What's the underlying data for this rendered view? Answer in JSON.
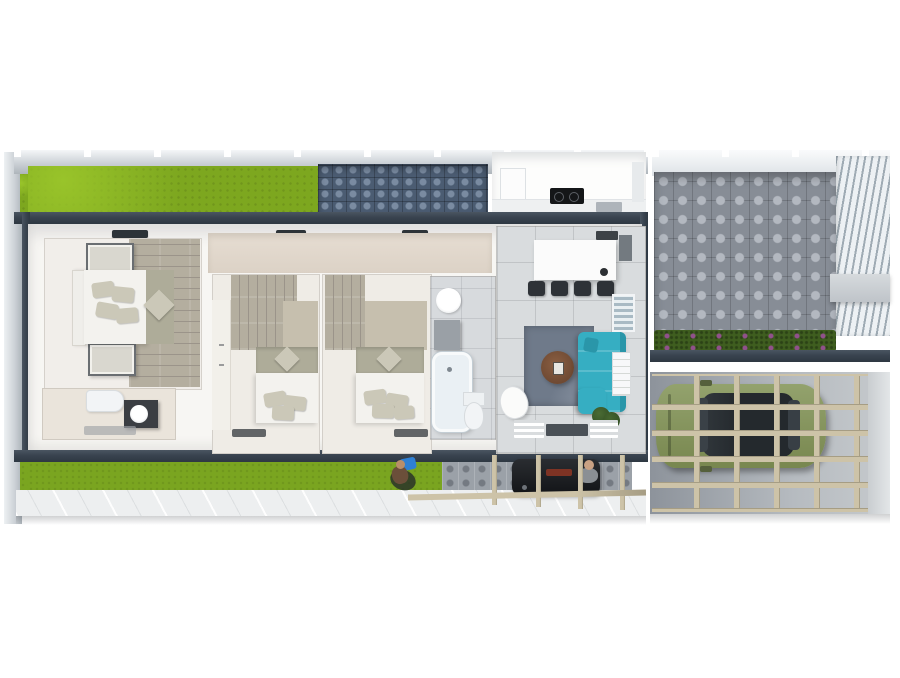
{
  "scene": {
    "description": "3D rendered top-down floor plan of a single-story house with attached carport, courtyard patio, lawns and BBQ area",
    "image_type": "architectural-3d-render-top-view",
    "visible_text": "none"
  },
  "colors": {
    "bg": "#ffffff",
    "fence": "#ccd1d6",
    "fenceDark": "#aeb5bb",
    "grassTop": "#7da71f",
    "grassBright": "#99c42a",
    "grassBottom": "#7aa520",
    "wallDark": "#39434f",
    "wallDark2": "#2e3842",
    "brickBase": "#4b5c72",
    "brickLight": "#7a8ba1",
    "paverBase": "#878d96",
    "paverLight": "#b3b8c0",
    "hedge": "#3f5e1f",
    "flower": "#91518b",
    "louverBg": "#edf1f4",
    "louverSlat": "#9fabb4",
    "tan": "#cdc3a8",
    "tanDark": "#a69d84",
    "carBody": "#93a26d",
    "carBodyDark": "#78874f",
    "carRoof": "#24292d",
    "garageL": "#8d939b",
    "garageR": "#c6cacd",
    "interior": "#f7f6f3",
    "corridor": "#dcd2c6",
    "wood": "#b4ae9f",
    "woodLine": "#9b948a",
    "woodLight": "#c6bfae",
    "headboard": "#aeac99",
    "bedWhite": "#f3f2ee",
    "pillow": "#cbc8b8",
    "tileBath": "#d7dadd",
    "tileLiving": "#d9dcde",
    "island": "#fbfbfb",
    "stool": "#2e3237",
    "rug": "#6f7a8a",
    "rugLight": "#8e98a6",
    "tableBrown": "#6f4a33",
    "teal": "#36aec2",
    "tealDark": "#2a96a9",
    "deckDark": "#4a5056",
    "plant": "#2e4a22",
    "toiletWhite": "#f2f4f6",
    "vanityDark": "#3b3e43",
    "paveBottom": "#edeff0",
    "paverSmall": "#9ba1a8",
    "cooktop": "#141618",
    "chair": "#d9d7cf",
    "chairFrame": "#6a6e72"
  },
  "regions": [
    {
      "name": "front-lawn"
    },
    {
      "name": "brick-privacy-wall"
    },
    {
      "name": "kitchen"
    },
    {
      "name": "master-bedroom"
    },
    {
      "name": "ensuite-bathroom"
    },
    {
      "name": "hallway"
    },
    {
      "name": "bedroom-2"
    },
    {
      "name": "bedroom-3"
    },
    {
      "name": "bathroom"
    },
    {
      "name": "living-dining-area"
    },
    {
      "name": "courtyard-patio"
    },
    {
      "name": "carport-garage"
    },
    {
      "name": "back-lawn"
    },
    {
      "name": "bbq-patio"
    },
    {
      "name": "walkway"
    }
  ],
  "objects": {
    "car": "olive-green hatchback under pergola",
    "sofa": "teal L-shaped sectional",
    "rug": "blue-gray area rug",
    "coffee_table": "round brown table",
    "bar_stools_count": 4,
    "beds_count": 3,
    "bbq": "black grill",
    "people_count": 2,
    "plant": "potted plant",
    "bathtub": 1,
    "toilets_count": 3,
    "basins_count": 2,
    "cooktop": "black 2-burner",
    "louver_screen": "white slatted privacy screen",
    "hedge": "flowering hedge strip"
  }
}
